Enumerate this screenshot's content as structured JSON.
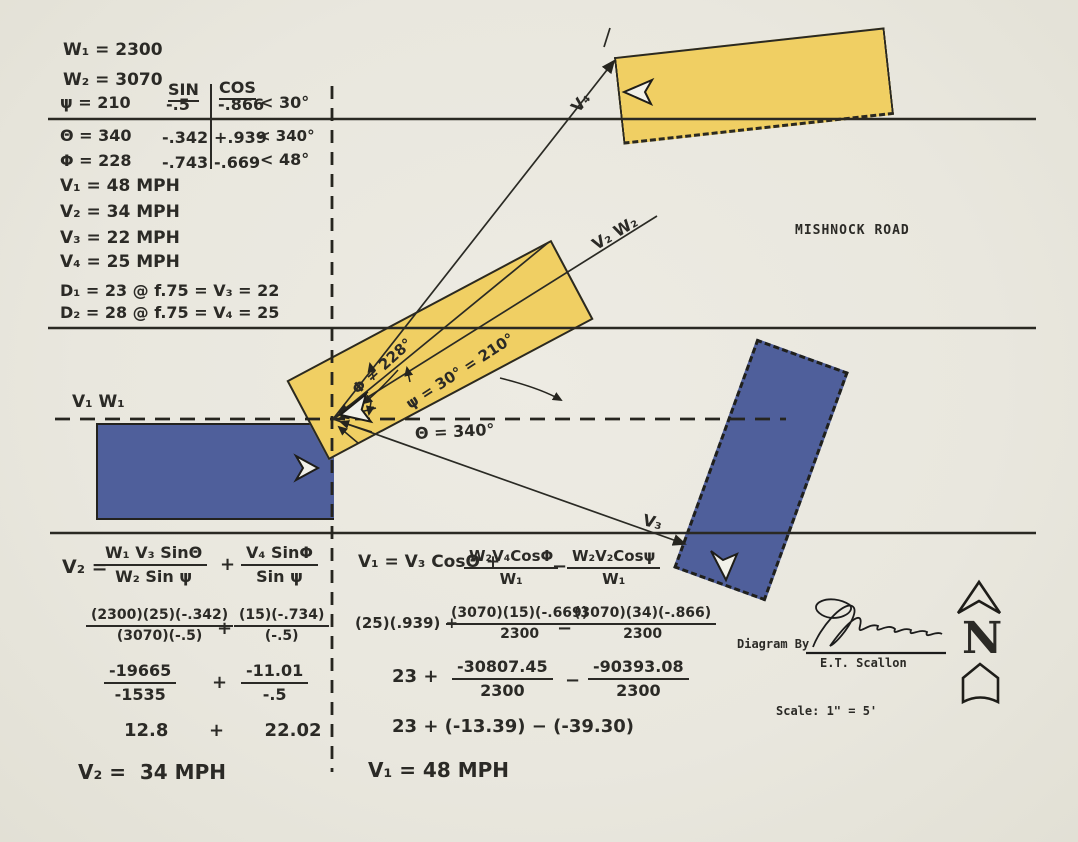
{
  "notes": {
    "w1": "W₁ = 2300",
    "w2": "W₂ = 3070",
    "sin_header": "SIN",
    "cos_header": "COS",
    "psi_row": {
      "label": "ψ = 210",
      "sin": "-.5",
      "cos": "-.866",
      "angle": "< 30°"
    },
    "theta_row": {
      "label": "Θ = 340",
      "sin": "-.342",
      "cos": "+.939",
      "angle": "< 340°"
    },
    "phi_row": {
      "label": "Φ = 228",
      "sin": "-.743",
      "cos": "-.669",
      "angle": "< 48°"
    },
    "v1": "V₁ = 48 MPH",
    "v2": "V₂ = 34 MPH",
    "v3": "V₃ = 22 MPH",
    "v4": "V₄ = 25 MPH",
    "d1": "D₁ = 23 @ f.75 = V₃ = 22",
    "d2": "D₂ = 28 @ f.75 = V₄ = 25"
  },
  "diagram": {
    "road_name": "MISHNOCK ROAD",
    "v1w1_label": "V₁ W₁",
    "v2w2_label": "V₂ W₂",
    "v3_label": "V₃",
    "v4_label": "V₄",
    "phi_annotation": "Φ = 228°",
    "psi_annotation": "ψ = 30° = 210°",
    "theta_annotation": "Θ = 340°"
  },
  "calc_left": {
    "lhs": "V₂ =",
    "step1": {
      "f1_num": "W₁ V₃ SinΘ",
      "f1_den": "W₂ Sin ψ",
      "op": "+",
      "f2_num": "V₄ SinΦ",
      "f2_den": "Sin ψ"
    },
    "step2": {
      "f1_num": "(2300)(25)(-.342)",
      "f1_den": "(3070)(-.5)",
      "op": "+",
      "f2_num": "(15)(-.734)",
      "f2_den": "(-.5)"
    },
    "step3": {
      "f1_num": "-19665",
      "f1_den": "-1535",
      "op": "+",
      "f2_num": "-11.01",
      "f2_den": "-.5"
    },
    "step4": "12.8  +  22.02",
    "result": "V₂ =  34 MPH"
  },
  "calc_right": {
    "lhs": "V₁ = V₃ CosΘ +",
    "step1": {
      "f1_num": "W₂V₄CosΦ",
      "f1_den": "W₁",
      "op": "−",
      "f2_num": "W₂V₂Cosψ",
      "f2_den": "W₁"
    },
    "step2": {
      "pre": "(25)(.939) +",
      "f1_num": "(3070)(15)(-.669)",
      "f1_den": "2300",
      "op": "−",
      "f2_num": "(3070)(34)(-.866)",
      "f2_den": "2300"
    },
    "step3": {
      "pre": "23 +",
      "f1_num": "-30807.45",
      "f1_den": "2300",
      "op": "−",
      "f2_num": "-90393.08",
      "f2_den": "2300"
    },
    "step4": "23 + (-13.39) − (-39.30)",
    "result": "V₁ = 48 MPH"
  },
  "footer": {
    "diagram_by": "Diagram By",
    "signed_name": "E.T. Scallon",
    "scale": "Scale: 1\" = 5'",
    "north_letter": "N"
  },
  "colors": {
    "paper": "#e9e7de",
    "car_yellow": "#f0cf63",
    "car_blue": "#4f5f9b",
    "ink": "#2b2a26"
  }
}
